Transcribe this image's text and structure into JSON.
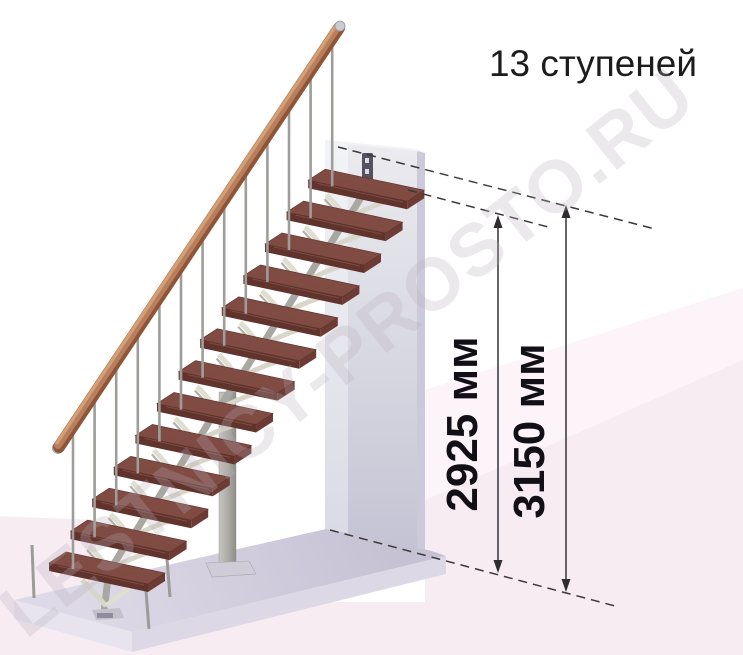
{
  "title": "13 ступеней",
  "watermark": "LESTNICY-PROSTO.RU",
  "stairs": {
    "steps": 13,
    "description": "модульная лестница на центральном косоуре"
  },
  "dimensions": {
    "inner": {
      "label": "2925 мм",
      "value": 2925,
      "unit": "мм"
    },
    "outer": {
      "label": "3150 мм",
      "value": 3150,
      "unit": "мм"
    }
  },
  "colors": {
    "tread_top": "#7f4b43",
    "tread_front": "#61332d",
    "tread_end": "#6e3b34",
    "handrail_wood": "#b97f5c",
    "metal_gray": "#a9a7a1",
    "branch_light": "#e0ddd1",
    "wall_light": "#e9e9ee",
    "wall_dark": "#c2c2d3",
    "platform": "#d3cfdf",
    "floor_pink": "#f8ecf3",
    "line_dark": "#3a3a3a"
  }
}
